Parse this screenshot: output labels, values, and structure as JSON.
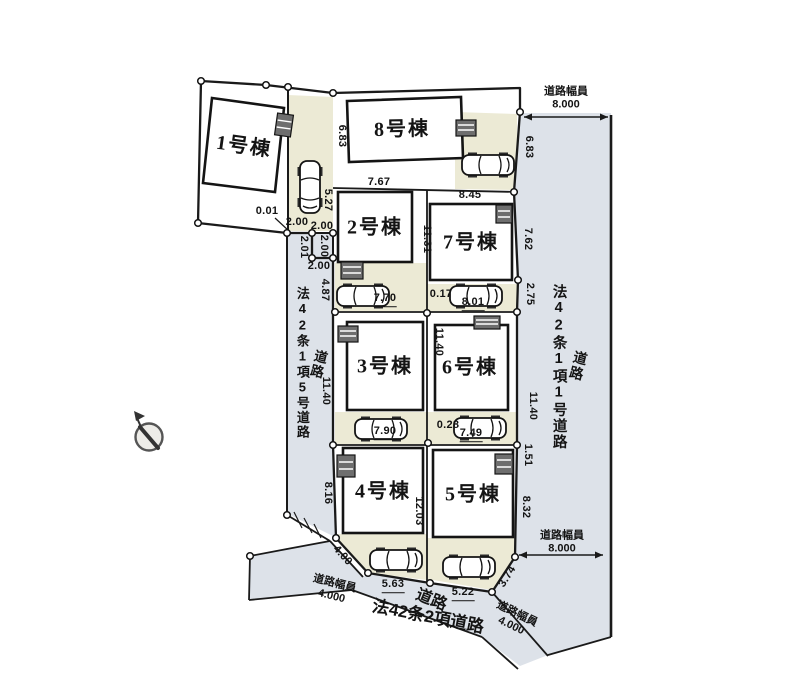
{
  "plan": {
    "buildings": [
      "1号棟",
      "2号棟",
      "3号棟",
      "4号棟",
      "5号棟",
      "6号棟",
      "7号棟",
      "8号棟"
    ],
    "roads": {
      "left": {
        "label": "道路",
        "type": "法42条1項5号道路"
      },
      "right": {
        "label": "道路",
        "type": "法42条1項1号道路"
      },
      "bottom": {
        "label": "道路",
        "type": "法42条2項道路"
      }
    },
    "road_widths": {
      "caption": "道路幅員",
      "top_right": "8.000",
      "mid_right": "8.000",
      "bottom_left": "4.000",
      "bottom_right": "4.000"
    },
    "dims": {
      "d001": "0.01",
      "d200a": "2.00",
      "d527": "5.27",
      "d683a": "6.83",
      "d767": "7.67",
      "d845": "8.45",
      "d683b": "6.83",
      "jog_top": "2.00",
      "jog_left": "2.01",
      "jog_right": "2.00",
      "jog_bottom": "2.00",
      "d487": "4.87",
      "d1131": "11.31",
      "d762": "7.62",
      "d275": "2.75",
      "d770": "7.70",
      "d017": "0.17",
      "d801": "8.01",
      "d1140_road": "11.40",
      "d1140_lot6": "11.40",
      "d1140_right": "11.40",
      "d790": "7.90",
      "d028": "0.28",
      "d749": "7.49",
      "d151": "1.51",
      "d816": "8.16",
      "d1203": "12.03",
      "d832": "8.32",
      "d400": "4.00",
      "d563": "5.63",
      "d522": "5.22",
      "d374": "3.74"
    },
    "colors": {
      "road": "#dde2e9",
      "parking": "#ecead5",
      "line": "#1a1a1a"
    }
  }
}
